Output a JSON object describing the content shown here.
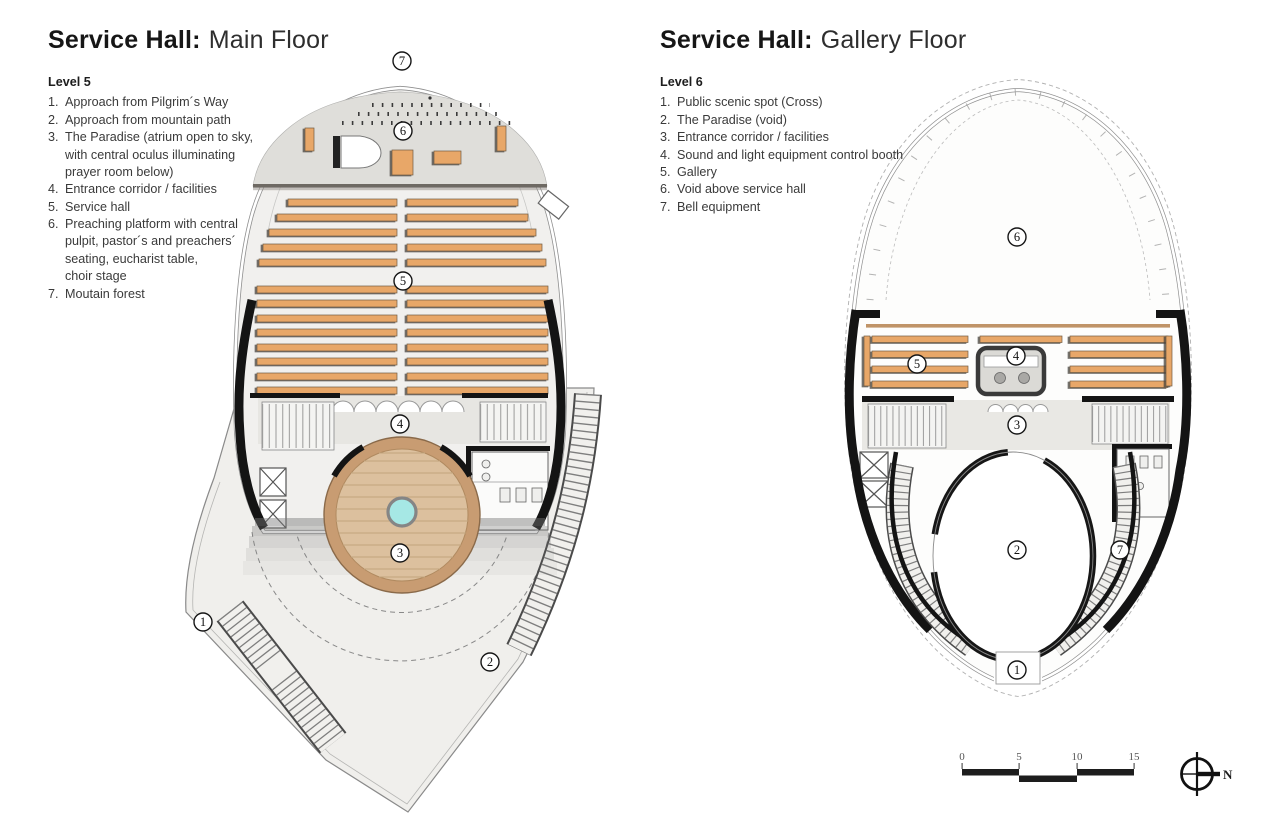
{
  "plans": {
    "main": {
      "title_bold": "Service Hall:",
      "title_light": "Main Floor",
      "legend": {
        "level": "Level 5",
        "items": [
          {
            "num": "1.",
            "text": "Approach from Pilgrim´s Way"
          },
          {
            "num": "2.",
            "text": "Approach from mountain path"
          },
          {
            "num": "3.",
            "text": "The Paradise (atrium open to sky,\nwith central oculus illuminating\nprayer room below)"
          },
          {
            "num": "4.",
            "text": "Entrance corridor / facilities"
          },
          {
            "num": "5.",
            "text": "Service hall"
          },
          {
            "num": "6.",
            "text": "Preaching platform with central\npulpit, pastor´s and preachers´\nseating, eucharist table,\nchoir stage"
          },
          {
            "num": "7.",
            "text": "Moutain forest"
          }
        ]
      },
      "callouts": [
        "1",
        "2",
        "3",
        "4",
        "5",
        "6",
        "7"
      ]
    },
    "gallery": {
      "title_bold": "Service Hall:",
      "title_light": "Gallery Floor",
      "legend": {
        "level": "Level 6",
        "items": [
          {
            "num": "1.",
            "text": "Public scenic spot (Cross)"
          },
          {
            "num": "2.",
            "text": "The Paradise (void)"
          },
          {
            "num": "3.",
            "text": "Entrance corridor / facilities"
          },
          {
            "num": "4.",
            "text": "Sound and light equipment control booth"
          },
          {
            "num": "5.",
            "text": "Gallery"
          },
          {
            "num": "6.",
            "text": "Void above service hall"
          },
          {
            "num": "7.",
            "text": "Bell equipment"
          }
        ]
      },
      "callouts": [
        "1",
        "2",
        "3",
        "4",
        "5",
        "6",
        "7"
      ]
    }
  },
  "scale_bar": {
    "ticks": [
      "0",
      "5",
      "10",
      "15"
    ]
  },
  "compass": {
    "label": "N"
  },
  "colors": {
    "pew_wood": "#E8A768",
    "deck_wood": "#DCC09E",
    "deck_ring": "#C89C72",
    "oculus": "#A6E8E5",
    "wall": "#141414",
    "platform_gray": "#DFDEDA",
    "hall_floor": "#F1F0EE",
    "terrace": "#F0EFEC"
  }
}
